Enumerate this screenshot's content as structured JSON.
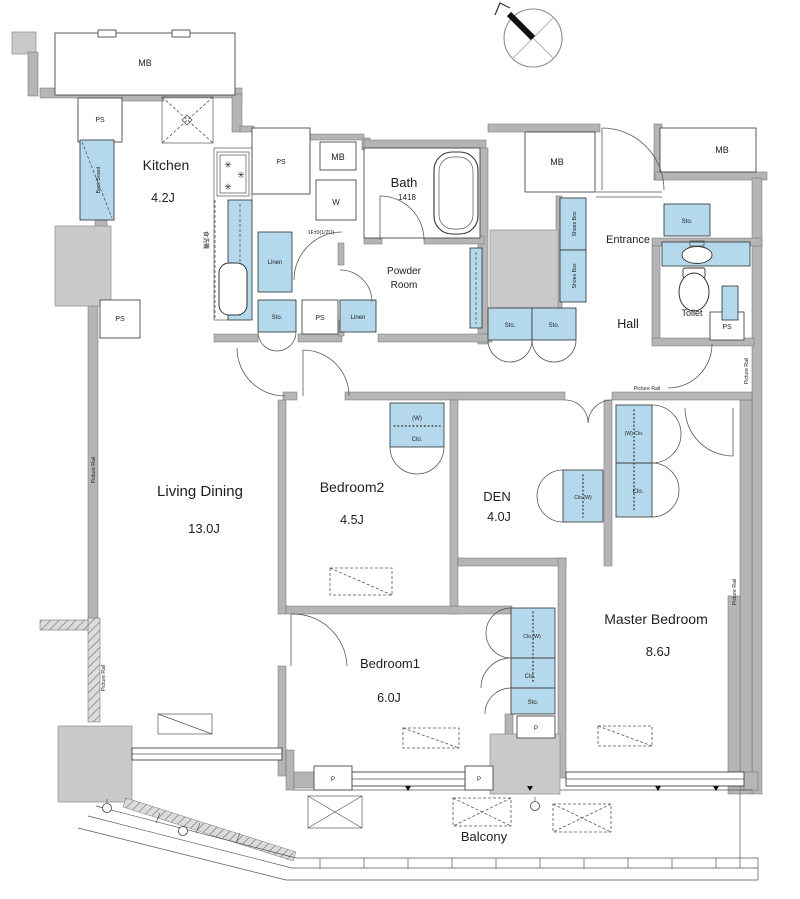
{
  "colors": {
    "wall_gray": "#b5b5b5",
    "column_gray": "#c9c9c9",
    "cabinet_blue": "#b4d9ec",
    "line": "#3f3f3f",
    "background": "#ffffff"
  },
  "rooms": {
    "kitchen": {
      "name": "Kitchen",
      "size": "4.2J"
    },
    "bath": {
      "name": "Bath",
      "size": "1418"
    },
    "powder_room": {
      "line1": "Powder",
      "line2": "Room"
    },
    "entrance": {
      "name": "Entrance"
    },
    "hall": {
      "name": "Hall"
    },
    "toilet": {
      "name": "Toilet"
    },
    "living_dining": {
      "name": "Living Dining",
      "size": "13.0J"
    },
    "bedroom2": {
      "name": "Bedroom2",
      "size": "4.5J"
    },
    "den": {
      "name": "DEN",
      "size": "4.0J"
    },
    "bedroom1": {
      "name": "Bedroom1",
      "size": "6.0J"
    },
    "master_bedroom": {
      "name": "Master Bedroom",
      "size": "8.6J"
    },
    "balcony": {
      "name": "Balcony"
    }
  },
  "labels": {
    "meter_box": "MB",
    "pipe_space": "PS",
    "washing_machine": "W",
    "linen": "Linen",
    "storage": "Sto.",
    "shoes_box": "Shoes Box",
    "closet": "Clo.",
    "closet_w": "Clo.(W)",
    "w_closet": "(W) Clo.",
    "w_mark": "(W)",
    "back_board": "Back Board",
    "picture_rail": "Picture Rail",
    "pillar": "P",
    "dishwasher": "食洗機",
    "washer_note": "1F±0(1/2O)"
  }
}
